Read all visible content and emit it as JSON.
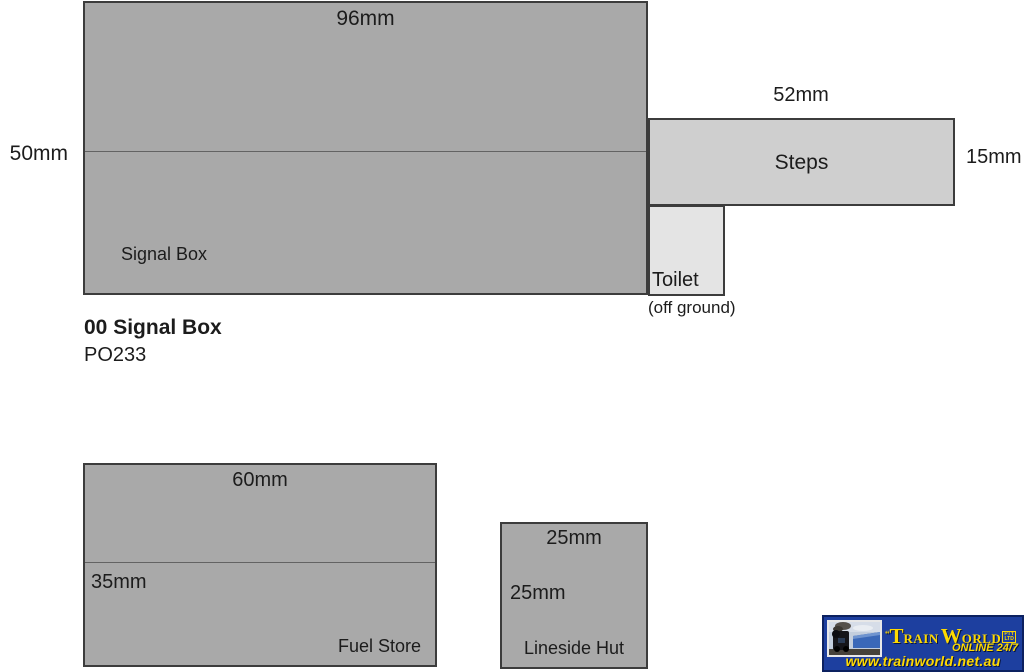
{
  "diagram": {
    "signal_box": {
      "name": "Signal Box",
      "top_dim": "96mm",
      "left_dim": "50mm"
    },
    "steps": {
      "name": "Steps",
      "top_dim": "52mm",
      "right_dim": "15mm"
    },
    "toilet": {
      "name": "Toilet",
      "note": "(off ground)"
    },
    "product": {
      "title": "00 Signal Box",
      "code": "PO233"
    },
    "fuel_store": {
      "name": "Fuel Store",
      "top_dim": "60mm",
      "left_dim": "35mm"
    },
    "lineside_hut": {
      "name": "Lineside Hut",
      "top_dim": "25mm",
      "left_dim": "25mm"
    }
  },
  "logo": {
    "brand_prefix": "“",
    "brand_part1": "T",
    "brand_part2": "RAIN",
    "brand_part3": "W",
    "brand_part4": "ORLD",
    "brand_suffix_line1": "PTY",
    "brand_suffix_line2": "LTD",
    "tagline": "ONLINE 24/7",
    "url": "www.trainworld.net.au"
  },
  "colors": {
    "footprint_fill_dark": "#a9a9a9",
    "footprint_fill_medium": "#cfcfcf",
    "footprint_fill_light": "#e4e4e4",
    "footprint_border": "#3c3c3c",
    "banner_blue": "#1d3f9f",
    "banner_navy": "#0c2160",
    "banner_yellow": "#ffd900",
    "text": "#1c1c1c"
  }
}
